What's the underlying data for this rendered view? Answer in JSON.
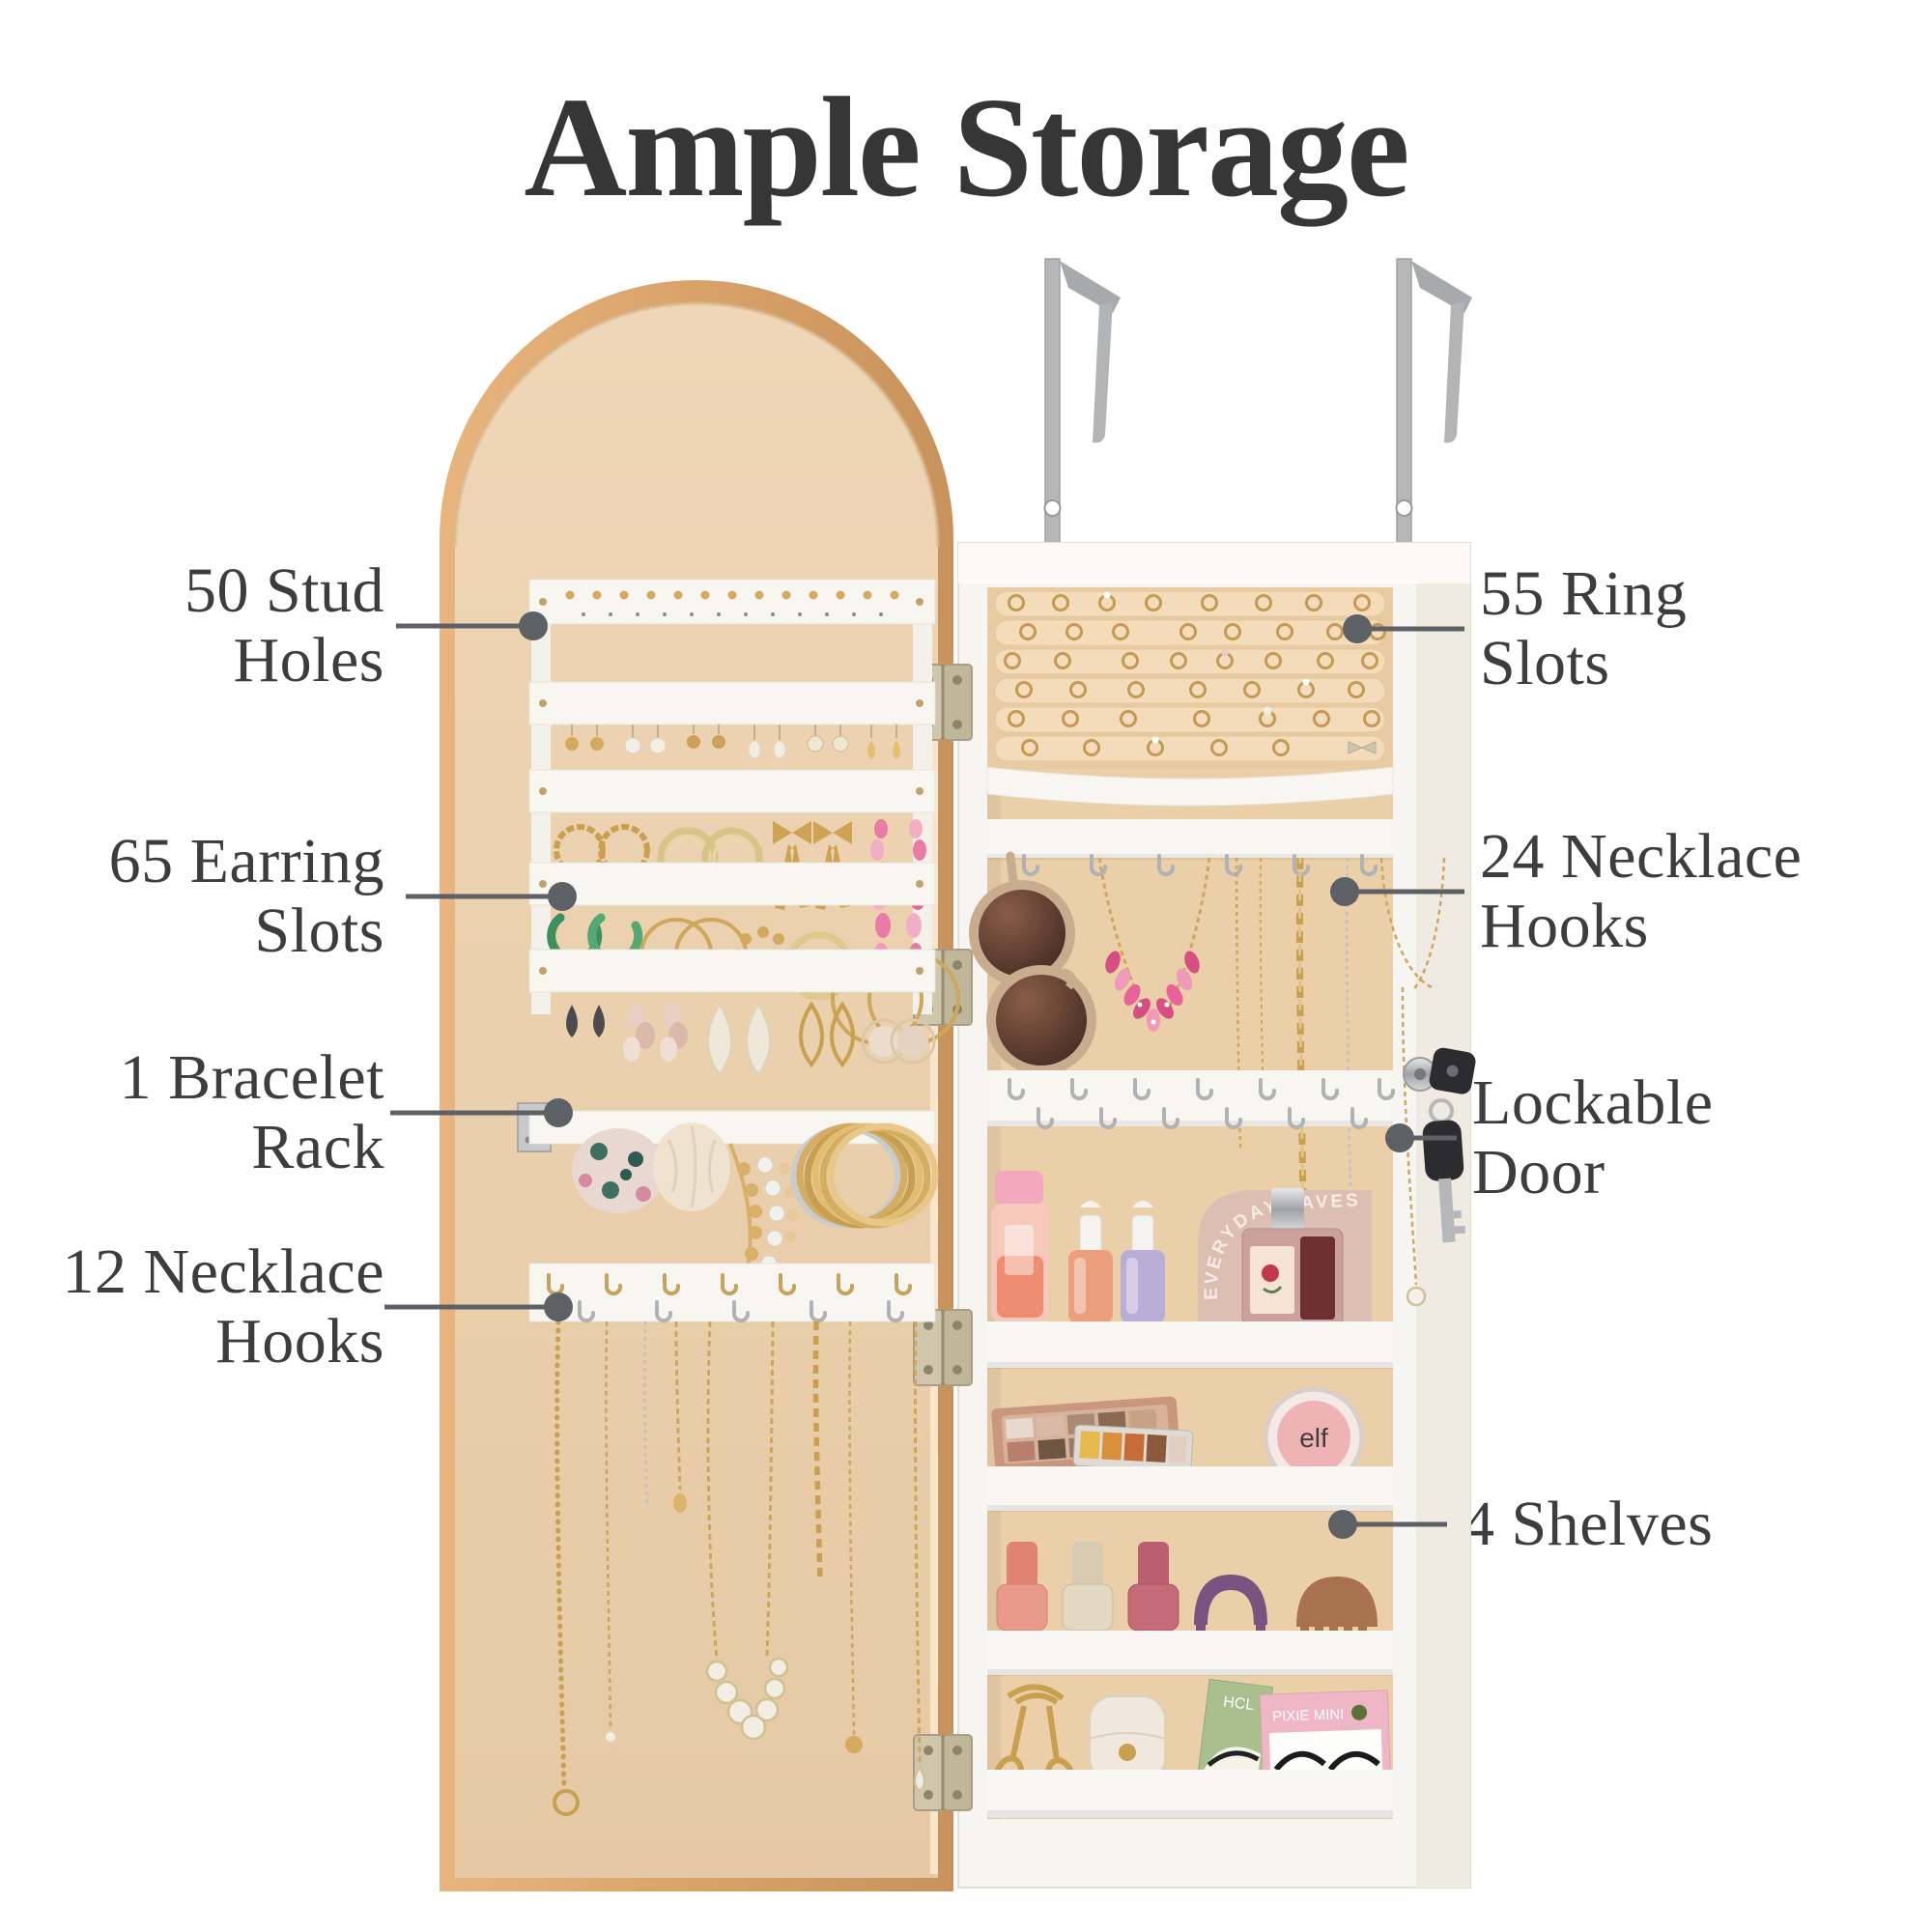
{
  "title": "Ample Storage",
  "callouts": {
    "left": [
      {
        "id": "stud-holes",
        "line1": "50 Stud",
        "line2": "Holes"
      },
      {
        "id": "earring-slots",
        "line1": "65 Earring",
        "line2": "Slots"
      },
      {
        "id": "bracelet-rack",
        "line1": "1 Bracelet",
        "line2": "Rack"
      },
      {
        "id": "necklace-hooks-12",
        "line1": "12 Necklace",
        "line2": "Hooks"
      }
    ],
    "right": [
      {
        "id": "ring-slots",
        "line1": "55 Ring",
        "line2": "Slots"
      },
      {
        "id": "necklace-hooks-24",
        "line1": "24 Necklace",
        "line2": "Hooks"
      },
      {
        "id": "lockable-door",
        "line1": "Lockable",
        "line2": "Door"
      },
      {
        "id": "shelves",
        "line1": "4 Shelves",
        "line2": ""
      }
    ]
  },
  "product_labels": {
    "perfume_card": "EVERYDAY FAVES",
    "blush_brand": "elf",
    "lash_box_green": "HCL",
    "lash_box_pink": "PIXIE MINI"
  },
  "colors": {
    "background": "#ffffff",
    "title_text": "#363636",
    "label_text": "#3d3d3d",
    "leader_line": "#5d6166",
    "door_frame_gold": "#dca873",
    "door_panel_tan": "#ecd2b2",
    "cabinet_white": "#f7f5f1",
    "cabinet_back_tan": "#ebcfa8",
    "organizer_white": "#f8f6f1",
    "jewelry_gold": "#c9a050",
    "hardware_silver": "#b5b7b9",
    "key_black": "#2c2c2e",
    "accent_pink": "#d64f82",
    "accent_green": "#3e8f5f"
  }
}
